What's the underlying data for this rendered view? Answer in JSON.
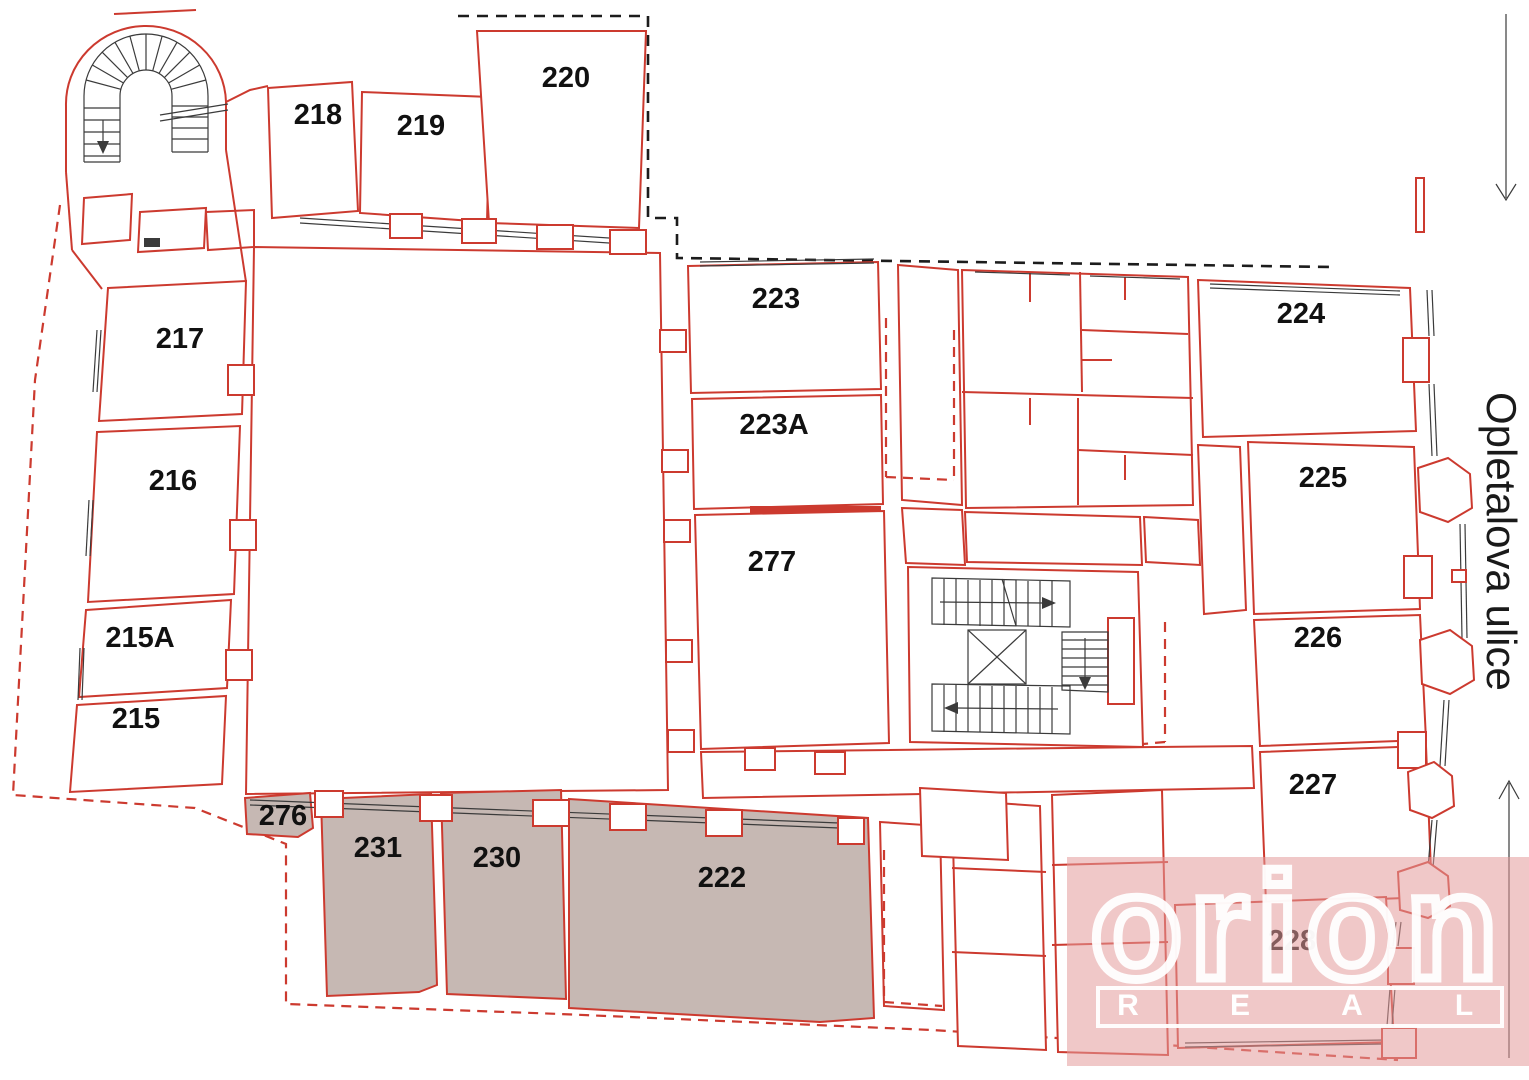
{
  "street": {
    "label": "Opletalova ulice"
  },
  "arrows": {
    "top_right": "down",
    "bottom_right": "up"
  },
  "watermark": {
    "brand": "orion",
    "band": [
      "R",
      "E",
      "A",
      "L"
    ]
  },
  "rooms": [
    {
      "label": "217",
      "shaded": false
    },
    {
      "label": "216",
      "shaded": false
    },
    {
      "label": "215A",
      "shaded": false
    },
    {
      "label": "215",
      "shaded": false
    },
    {
      "label": "218",
      "shaded": false
    },
    {
      "label": "219",
      "shaded": false
    },
    {
      "label": "220",
      "shaded": false
    },
    {
      "label": "223",
      "shaded": false
    },
    {
      "label": "223A",
      "shaded": false
    },
    {
      "label": "277",
      "shaded": false
    },
    {
      "label": "224",
      "shaded": false
    },
    {
      "label": "225",
      "shaded": false
    },
    {
      "label": "226",
      "shaded": false
    },
    {
      "label": "227",
      "shaded": false
    },
    {
      "label": "228",
      "shaded": false
    },
    {
      "label": "276",
      "shaded": true
    },
    {
      "label": "231",
      "shaded": true
    },
    {
      "label": "230",
      "shaded": true
    },
    {
      "label": "222",
      "shaded": true
    }
  ],
  "colors": {
    "wall_red": "#cc3a2f",
    "shaded_room_fill": "#c6b8b3",
    "watermark_pink": "#efc2c2",
    "logo_white": "#ffffff",
    "label_black": "#111111",
    "thin_line_black": "#3b3b3b"
  }
}
